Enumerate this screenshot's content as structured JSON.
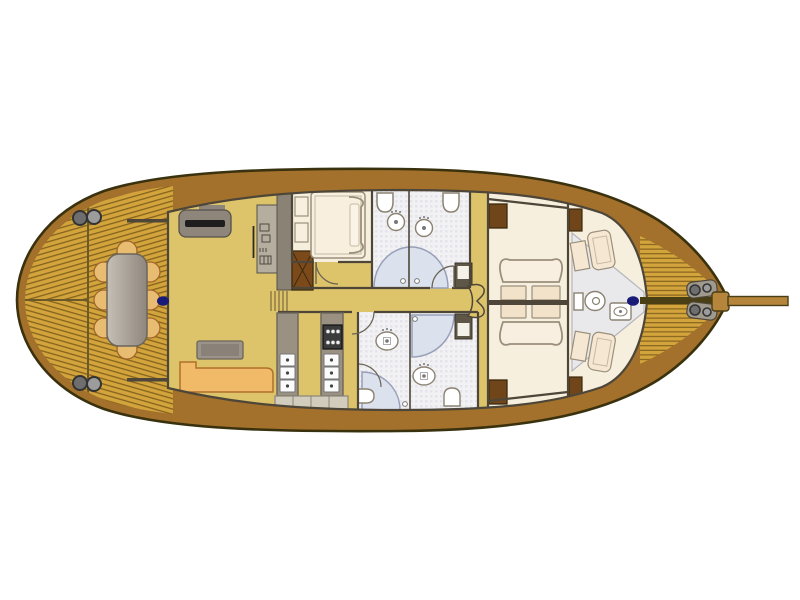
{
  "figure": {
    "type": "yacht-deck-floor-plan",
    "orientation": "bow-right",
    "text_labels": []
  },
  "palette": {
    "background": "#ffffff",
    "hull_outline": "#3a310e",
    "hull_band": "#a3712b",
    "deck_plank": "#d3a33c",
    "deck_plank_line": "#7d5e1b",
    "deck_seam": "#6b5a28",
    "interior_floor": "#ddc46a",
    "cabin_floor": "#f7efde",
    "cabin_outline": "#9a8f7b",
    "bath_floor": "#f2f2f4",
    "bath_grid": "#e4e4ea",
    "shower_fill": "#dce1ee",
    "shower_outline": "#98a0b8",
    "wall": "#4d4639",
    "counter_grey": "#9a9183",
    "counter_outline": "#6b655a",
    "stove_dark": "#3c3c3c",
    "unit_white": "#fbfbfb",
    "cabinet_light": "#d2ccbd",
    "sofa_tan": "#f0ba68",
    "sofa_outline": "#b0702a",
    "chair_tan": "#e8bd72",
    "chair_outline": "#a1652a",
    "table_grey_light": "#c6bfb6",
    "table_grey_dark": "#8f877d",
    "wood_dark": "#6f4519",
    "wood_dark_outline": "#3b2a0e",
    "navy": "#181a78",
    "metal_grey": "#9c9c9c",
    "metal_dark": "#6e6e6e",
    "metal_outline": "#333333",
    "fixture_outline": "#8b8272",
    "bowsprit_tan": "#b5853c",
    "panel_grey": "#b5ae9f",
    "column_grey": "#8a8274",
    "slot_dark": "#1e1e1e"
  },
  "aft_deck": {
    "dining_chairs": [
      [
        127,
        251
      ],
      [
        150,
        272
      ],
      [
        150,
        300
      ],
      [
        150,
        328
      ],
      [
        127,
        349
      ],
      [
        104,
        328
      ],
      [
        104,
        300
      ],
      [
        104,
        272
      ]
    ],
    "winch_pairs": [
      [
        80,
        218,
        94,
        217
      ],
      [
        80,
        383,
        94,
        384
      ]
    ],
    "mooring_dots": [
      [
        163,
        301
      ],
      [
        633,
        301
      ]
    ]
  },
  "galley": {
    "stove_burners": [
      [
        328,
        331.5
      ],
      [
        333,
        331.5
      ],
      [
        338,
        331.5
      ],
      [
        328,
        342.5
      ],
      [
        333,
        342.5
      ],
      [
        338,
        342.5
      ]
    ],
    "sink_units_left": [
      [
        280,
        354
      ],
      [
        280,
        367
      ],
      [
        280,
        380
      ]
    ],
    "sink_units_right": [
      [
        324,
        354
      ],
      [
        324,
        367
      ],
      [
        324,
        380
      ]
    ]
  },
  "bow": {
    "windlass_circles": [
      [
        695,
        290,
        5
      ],
      [
        707,
        288,
        4
      ],
      [
        695,
        310,
        5
      ],
      [
        707,
        312,
        4
      ]
    ]
  }
}
